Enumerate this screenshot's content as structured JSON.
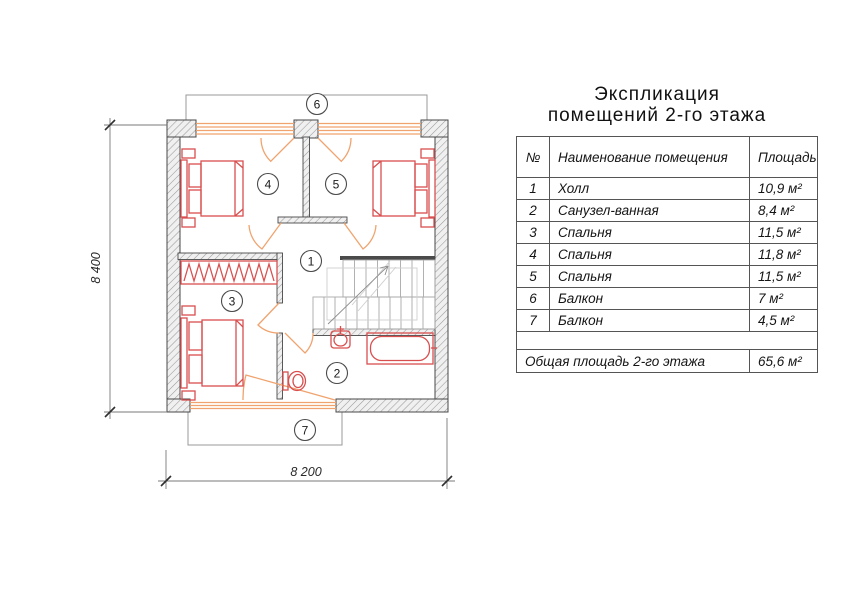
{
  "title": {
    "line1": "Экспликация",
    "line2": "помещений 2-го этажа"
  },
  "table": {
    "headers": {
      "num": "№",
      "name": "Наименование помещения",
      "area": "Площадь"
    },
    "rows": [
      {
        "num": "1",
        "name": "Холл",
        "area": "10,9 м²"
      },
      {
        "num": "2",
        "name": "Санузел-ванная",
        "area": "8,4 м²"
      },
      {
        "num": "3",
        "name": "Спальня",
        "area": "11,5 м²"
      },
      {
        "num": "4",
        "name": "Спальня",
        "area": "11,8 м²"
      },
      {
        "num": "5",
        "name": "Спальня",
        "area": "11,5 м²"
      },
      {
        "num": "6",
        "name": "Балкон",
        "area": "7 м²"
      },
      {
        "num": "7",
        "name": "Балкон",
        "area": "4,5 м²"
      }
    ],
    "total": {
      "label": "Общая площадь 2-го этажа",
      "area": "65,6 м²"
    }
  },
  "plan": {
    "rooms": [
      {
        "num": "1"
      },
      {
        "num": "2"
      },
      {
        "num": "3"
      },
      {
        "num": "4"
      },
      {
        "num": "5"
      },
      {
        "num": "6"
      },
      {
        "num": "7"
      }
    ],
    "dim_vertical": "8 400",
    "dim_horizontal": "8 200",
    "colors": {
      "furniture": "#d94f4f",
      "openings": "#f0a36e",
      "wall_line": "#474747",
      "wall_hatch": "#9a9a9a"
    }
  }
}
